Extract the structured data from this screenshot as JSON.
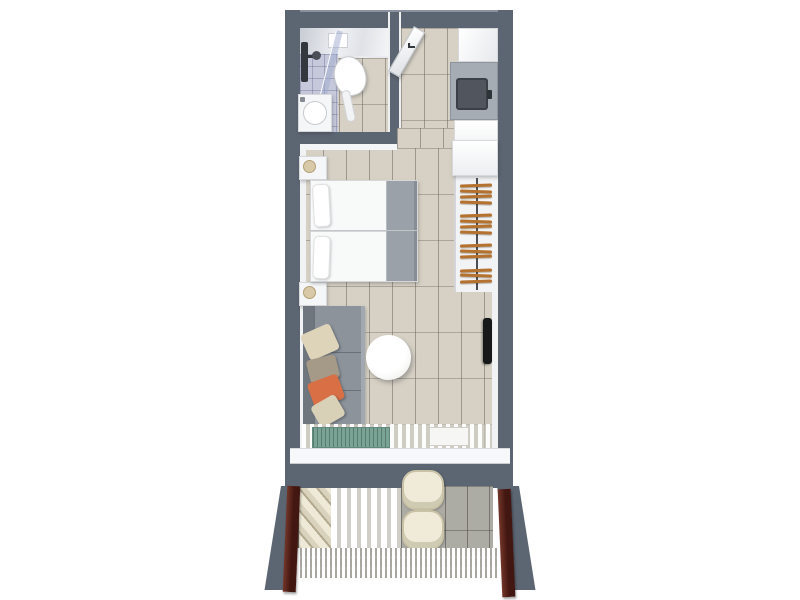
{
  "scene": {
    "kind": "hotel-room-floor-plan-3d-top-view",
    "background": "#ffffff"
  },
  "palette": {
    "wall": "#5c6572",
    "wall_edge": "#8a92a0",
    "floor_tile": "#d7d1c5",
    "balcony_tile": "#adaca4",
    "sofa": "#8c939b",
    "sofa_back": "#70767e",
    "bed_runner": "#9aa1a9",
    "hanger": "#b5722f",
    "curtain": "#431711",
    "rug": "#7aa396",
    "shower_floor": "#c6c9db",
    "fixture": "#33383f",
    "safe": "#51565e",
    "tv": "#17181a",
    "chair": "#efebd8",
    "lamp": "#d8c9a8"
  },
  "rooms": {
    "bathroom": {
      "items": [
        "shower-column",
        "glass-partition",
        "shower-floor",
        "toilet",
        "washbasin",
        "ceiling-light"
      ]
    },
    "entry": {
      "items": [
        "entrance-door",
        "door-handle",
        "cabinet",
        "safe"
      ]
    },
    "bedroom": {
      "items": [
        "twin-bed-1",
        "twin-bed-2",
        "nightstand-top",
        "nightstand-bottom",
        "bed-runner",
        "wardrobe",
        "hanger-rail"
      ]
    },
    "living": {
      "items": [
        "sofa",
        "pillows",
        "round-table",
        "tv",
        "teal-rug",
        "sheer-curtain",
        "floor-inset"
      ]
    },
    "balcony": {
      "items": [
        "chair-1",
        "chair-2",
        "louver-screen",
        "slat-stack",
        "floor-grating",
        "curtain-left",
        "curtain-right"
      ]
    }
  },
  "wardrobe": {
    "hanger_groups": [
      4,
      4,
      3,
      3
    ]
  },
  "seating": {
    "pillow_colors": [
      "#ded4ba",
      "#a59a88",
      "#d86f45",
      "#d9d0b8"
    ]
  },
  "balcony": {
    "chair_count": 2
  }
}
